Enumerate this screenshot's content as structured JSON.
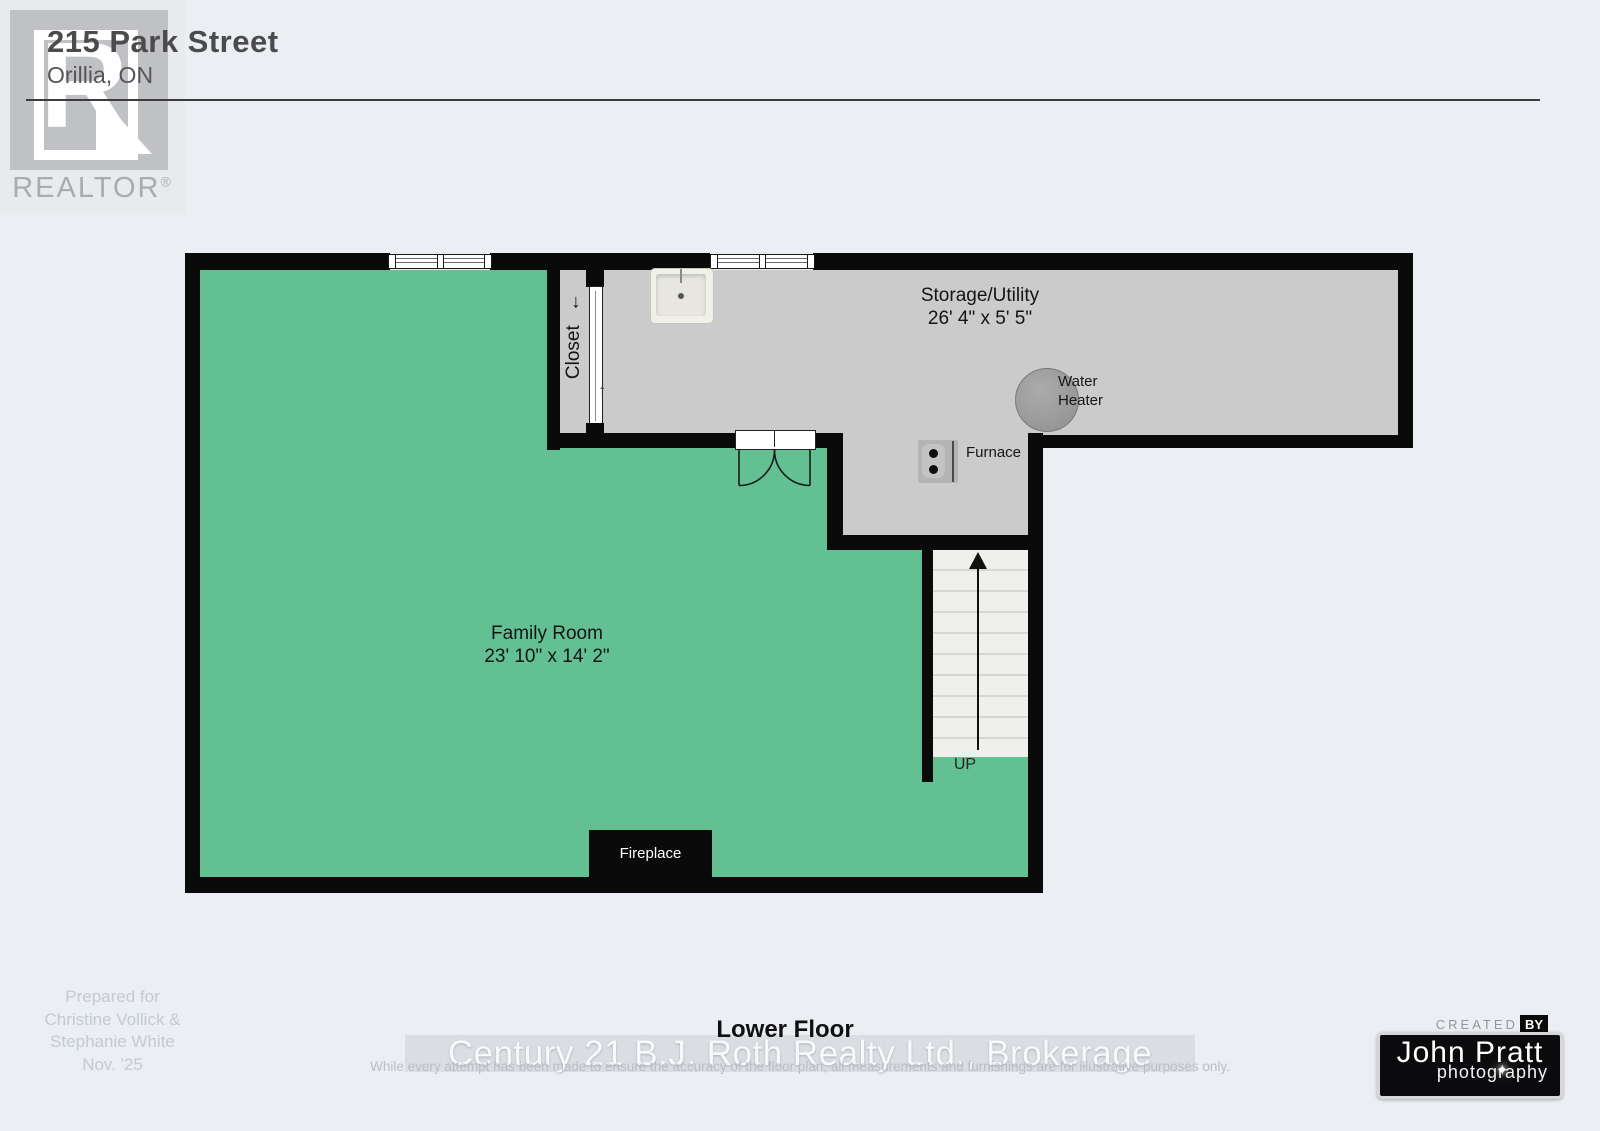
{
  "header": {
    "address_line1": "215 Park Street",
    "address_line2": "Orillia, ON",
    "logo": {
      "letter": "R",
      "label": "REALTOR",
      "registered_mark": "®"
    }
  },
  "floorplan": {
    "rooms": {
      "family_room": {
        "name": "Family Room",
        "dimensions": "23' 10\" x 14' 2\""
      },
      "storage_utility": {
        "name": "Storage/Utility",
        "dimensions": "26' 4\" x 5' 5\""
      },
      "closet": {
        "name": "Closet",
        "arrow": "←"
      }
    },
    "labels": {
      "water_heater": "Water Heater",
      "furnace": "Furnace",
      "fireplace": "Fireplace",
      "up": "UP"
    },
    "icons": {
      "closet_door_arrow": "↑"
    },
    "colors": {
      "room_green": "#63c093",
      "room_gray": "#cbcbcb",
      "wall": "#0a0a0a",
      "stair_fill": "#efefec"
    }
  },
  "footer": {
    "prepared_for": [
      "Prepared for",
      "Christine Vollick &",
      "Stephanie White",
      "Nov. '25"
    ],
    "floor_label": "Lower Floor",
    "watermark": "Century 21 B.J. Roth Realty Ltd., Brokerage",
    "disclaimer": "While every attempt has been made to ensure the accuracy of the floor plan, all measurements and furnishings are for illustrative purposes only."
  },
  "badge": {
    "created": "CREATED",
    "by": "BY",
    "name": "John Pratt",
    "subtitle": "photography",
    "sparkle": "✦"
  },
  "colors": {
    "page_background": "#ebeef2"
  }
}
